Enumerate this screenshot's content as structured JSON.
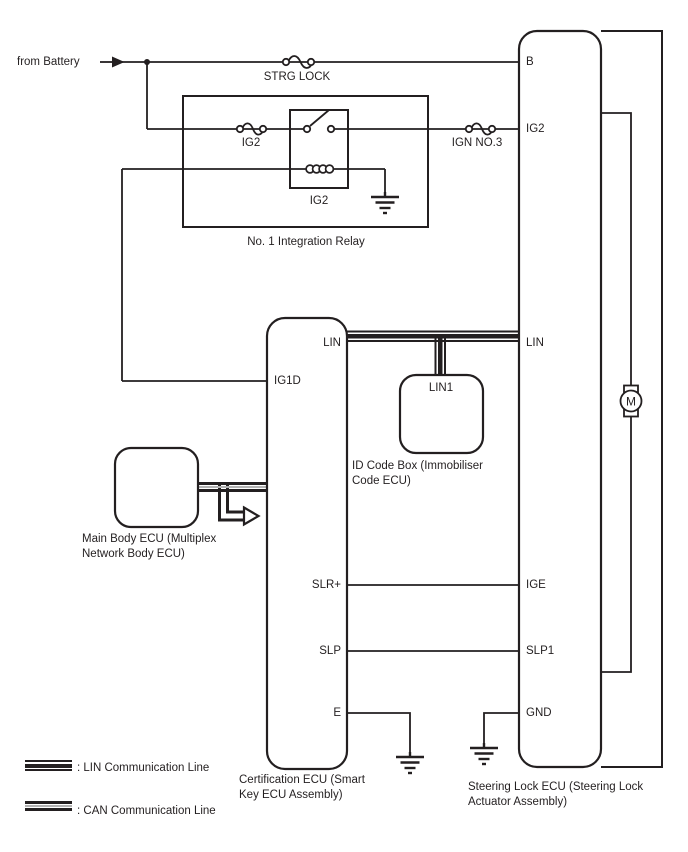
{
  "labels": {
    "from_battery": "from Battery",
    "strg_lock_fuse": "STRG LOCK",
    "ig2_fuse": "IG2",
    "ign_no3_fuse": "IGN NO.3",
    "relay_coil": "IG2",
    "relay_name": "No. 1 Integration Relay"
  },
  "certification_ecu": {
    "terminals": {
      "lin": "LIN",
      "ig1d": "IG1D",
      "slr_plus": "SLR+",
      "slp": "SLP",
      "e": "E"
    },
    "caption": [
      "Certification ECU (Smart",
      "Key ECU Assembly)"
    ]
  },
  "steering_lock_ecu": {
    "terminals": {
      "b": "B",
      "ig2": "IG2",
      "lin": "LIN",
      "ige": "IGE",
      "slp1": "SLP1",
      "gnd": "GND"
    },
    "motor": "M",
    "caption": [
      "Steering Lock ECU (Steering Lock",
      "Actuator Assembly)"
    ]
  },
  "id_code_box": {
    "terminal": "LIN1",
    "caption": [
      "ID Code Box (Immobiliser",
      "Code ECU)"
    ]
  },
  "main_body_ecu": {
    "caption": [
      "Main Body ECU (Multiplex",
      "Network Body ECU)"
    ]
  },
  "legend": {
    "lin": ": LIN Communication Line",
    "can": ": CAN Communication Line"
  },
  "colors": {
    "line": "#231f20",
    "background": "#ffffff",
    "can_center": "#b2b2b2"
  }
}
